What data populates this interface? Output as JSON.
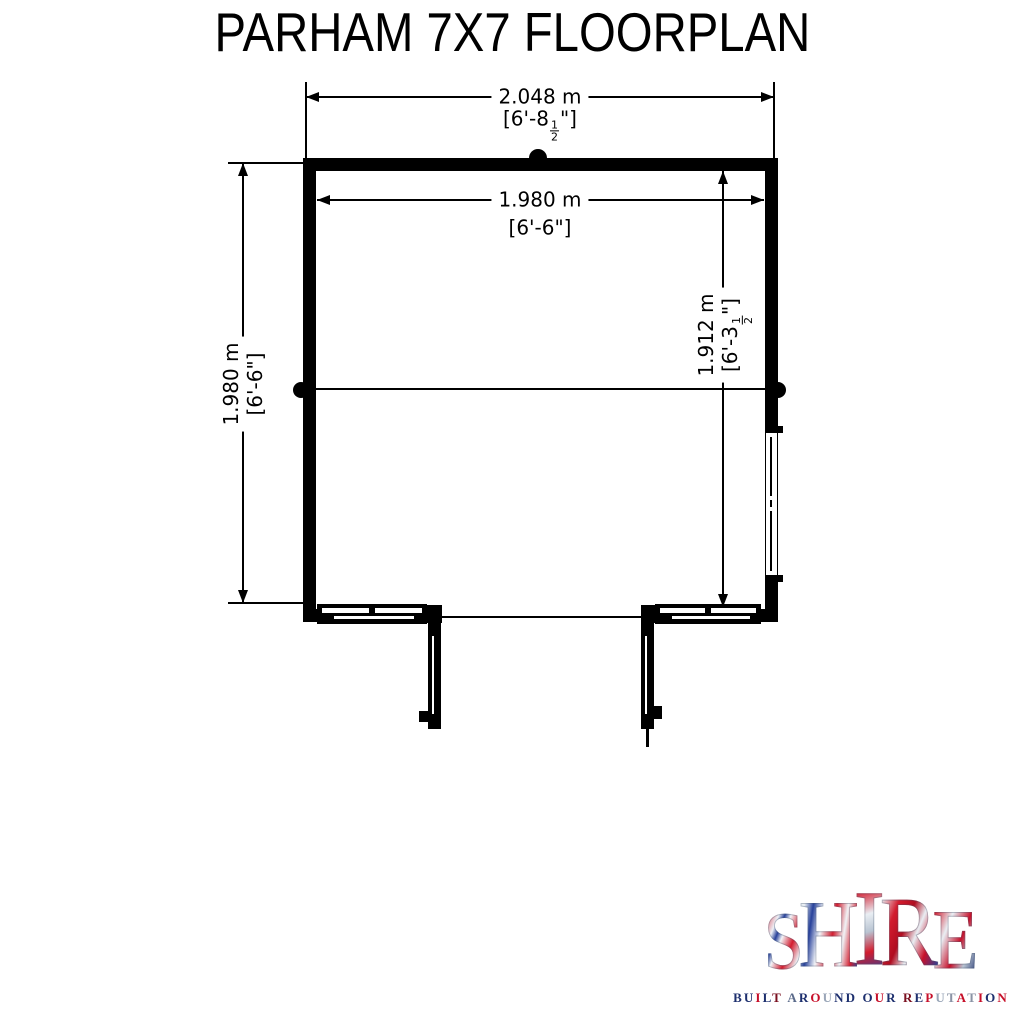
{
  "title": "PARHAM 7X7 FLOORPLAN",
  "dimensions": {
    "overall_width": {
      "metric": "2.048 m",
      "imp_open": "[6'-8",
      "frac_num": "1",
      "frac_den": "2",
      "imp_close": "\"]"
    },
    "inner_width": {
      "metric": "1.980 m",
      "imperial": "[6'-6\"]"
    },
    "overall_depth": {
      "metric": "1.980 m",
      "imperial": "[6'-6\"]"
    },
    "inner_depth": {
      "metric": "1.912 m",
      "imp_open": "[6'-3",
      "frac_num": "1",
      "frac_den": "2",
      "imp_close": "\"]"
    }
  },
  "logo": {
    "wordmark_letters": [
      "S",
      "H",
      "I",
      "R",
      "E"
    ],
    "tagline": "BUILT AROUND OUR REPUTATION",
    "tagline_colors": [
      "#1d2f6e",
      "#1d2f6e",
      "#c7102a",
      "#1d2f6e",
      "#7a1020",
      "",
      "#5a6a8a",
      "#1d2f6e",
      "#c7102a",
      "#9aa6b8",
      "#1d2f6e",
      "#1d2f6e",
      "",
      "#1d2f6e",
      "#c7102a",
      "#1d2f6e",
      "",
      "#7a1020",
      "#1d2f6e",
      "#c7102a",
      "#9aa6b8",
      "#8a93a5",
      "#c7102a",
      "#8a93a5",
      "#c7102a",
      "#1d2f6e",
      "#c7102a"
    ],
    "palette": {
      "red": "#cf1226",
      "navy": "#1d2f6e",
      "silver": "#aab4c4"
    }
  }
}
